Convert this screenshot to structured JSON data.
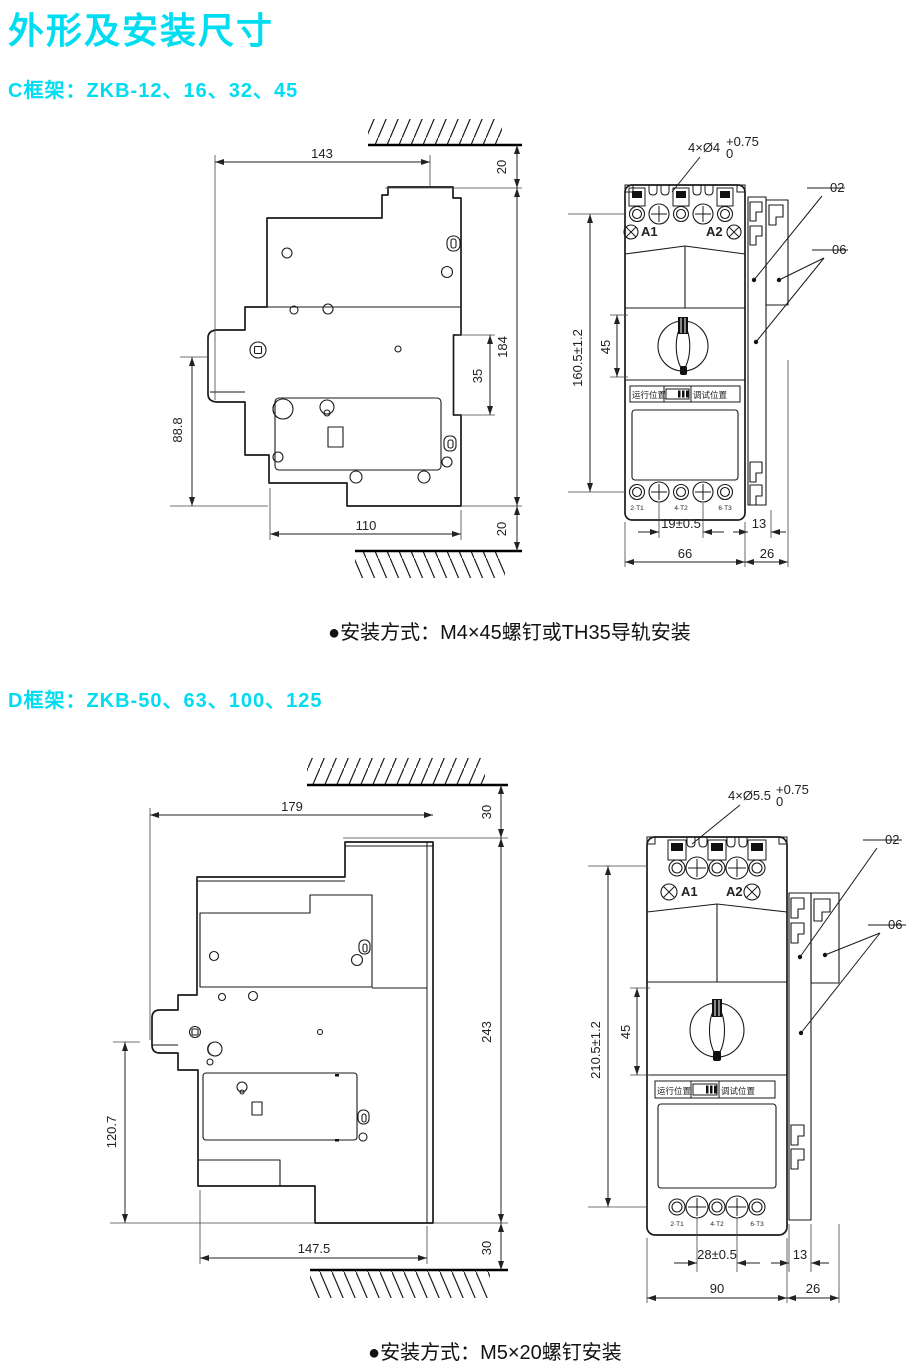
{
  "page": {
    "title": "外形及安装尺寸",
    "accent": "#00dcf0"
  },
  "frame_c": {
    "heading": "C框架：ZKB-12、16、32、45",
    "mounting": "●安装方式：M4×45螺钉或TH35导轨安装",
    "side": {
      "top_width": "143",
      "top_gap": "20",
      "total_height": "184",
      "rail_notch": "35",
      "lower_height": "88.8",
      "bottom_width": "110",
      "bottom_gap": "20"
    },
    "front": {
      "hole_note": "4×Ø4",
      "tol_sup": "+0.75",
      "tol_sub": "0",
      "callout_top": "02",
      "callout_bottom": "06",
      "height": "160.5±1.2",
      "handle_height": "45",
      "hole_pitch": "19±0.5",
      "rail_width": "13",
      "body_width": "66",
      "side_width": "26",
      "terminal_a1": "A1",
      "terminal_a2": "A2",
      "run_label": "运行位置",
      "test_label": "调试位置",
      "t1": "2·T1",
      "t2": "4·T2",
      "t3": "6·T3"
    }
  },
  "frame_d": {
    "heading": "D框架：ZKB-50、63、100、125",
    "mounting": "●安装方式：M5×20螺钉安装",
    "side": {
      "top_width": "179",
      "top_gap": "30",
      "total_height": "243",
      "lower_height": "120.7",
      "bottom_width": "147.5",
      "bottom_gap": "30"
    },
    "front": {
      "hole_note": "4×Ø5.5",
      "tol_sup": "+0.75",
      "tol_sub": "0",
      "callout_top": "02",
      "callout_bottom": "06",
      "height": "210.5±1.2",
      "handle_height": "45",
      "hole_pitch": "28±0.5",
      "rail_width": "13",
      "body_width": "90",
      "side_width": "26",
      "terminal_a1": "A1",
      "terminal_a2": "A2",
      "run_label": "运行位置",
      "test_label": "调试位置",
      "t1": "2·T1",
      "t2": "4·T2",
      "t3": "6·T3"
    }
  }
}
